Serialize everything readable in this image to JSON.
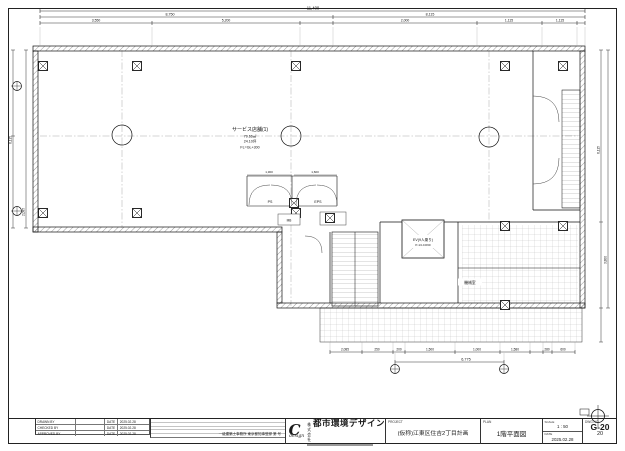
{
  "dims": {
    "top": {
      "total": "11,400",
      "row2_left": "8,750",
      "row2_right": "8,115",
      "seg1": "3,550",
      "seg2": "5,200",
      "seg3": "2,000",
      "seg4": "1,115",
      "seg5": "1,115"
    },
    "upper_small": {
      "left": "1,300",
      "right": "1,600"
    },
    "bottom": {
      "seg1": "2,085",
      "seg2": "250",
      "seg3": "200",
      "seg4": "1,500",
      "seg5": "1,000",
      "seg6": "1,580",
      "seg7": "280",
      "seg8": "600",
      "total": "6,775"
    },
    "left": {
      "d1": "6,115",
      "d2": "2,085"
    },
    "right": {
      "d1": "6,115",
      "d2": "3,800"
    }
  },
  "plan": {
    "shop": {
      "name": "サービス店舗(1)",
      "area_m2": "79.66㎡",
      "area_tsubo": "24.10坪",
      "floor_level": "FL=GL+300"
    },
    "elevator": {
      "line1": "EV(9人乗り)",
      "line2": "P-13-CO60"
    },
    "labels": {
      "ps": "PS",
      "eps": "EPS",
      "mb": "MB",
      "machine_room": "機械室"
    }
  },
  "titleblock": {
    "sign_table": {
      "rows": [
        {
          "role": "DRAWN BY",
          "name": "",
          "date_label": "DATE",
          "date": "2025.02.28"
        },
        {
          "role": "CHECKED BY",
          "name": "",
          "date_label": "DATE",
          "date": "2025.02.28"
        },
        {
          "role": "APPROVED BY",
          "name": "",
          "date_label": "DATE",
          "date": "2025.02.28"
        }
      ]
    },
    "registration": "一級建築士事務所 東京都知事登録 第 号",
    "company": {
      "prefix": "株式会社",
      "name": "都市環境デザイン",
      "logo_mark": "C",
      "logo_word": "design"
    },
    "fields": {
      "project_label": "PROJECT",
      "project": "(仮称)江東区住吉2丁目計画",
      "plan_label": "PLAN",
      "plan_title": "1階平面図",
      "scale_label": "SCALE",
      "scale": "1 : 50",
      "date_label": "DATE",
      "date": "2025.02.28",
      "dwg_label": "DWG.NO",
      "dwg_no": "G-20",
      "sheet_no": "20"
    }
  }
}
